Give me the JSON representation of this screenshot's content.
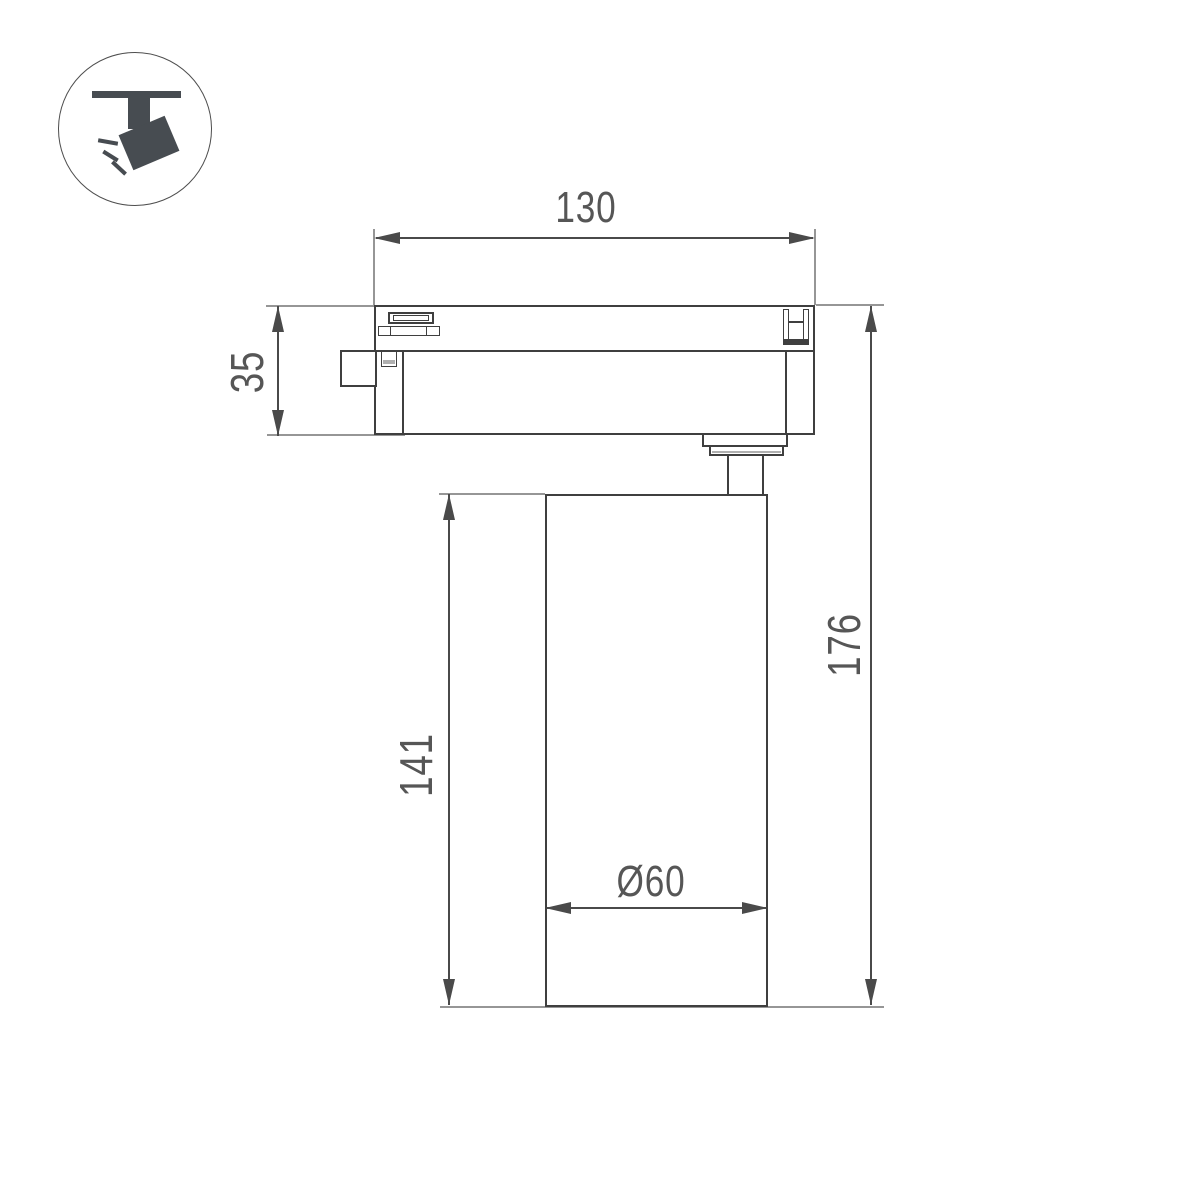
{
  "drawing": {
    "title": "track-spotlight-dimension-drawing",
    "labels": {
      "track_width": "130",
      "adapter_height": "35",
      "body_height": "141",
      "total_height": "176",
      "body_diameter": "Ø60"
    }
  },
  "icon": {
    "name": "track-spotlight-icon"
  },
  "colors": {
    "object_line": "#3f3f3f",
    "dimension_line": "#4a4a4a",
    "extension_line": "#969696",
    "label_text": "#565656",
    "icon_fill": "#474c51",
    "background": "#ffffff"
  }
}
